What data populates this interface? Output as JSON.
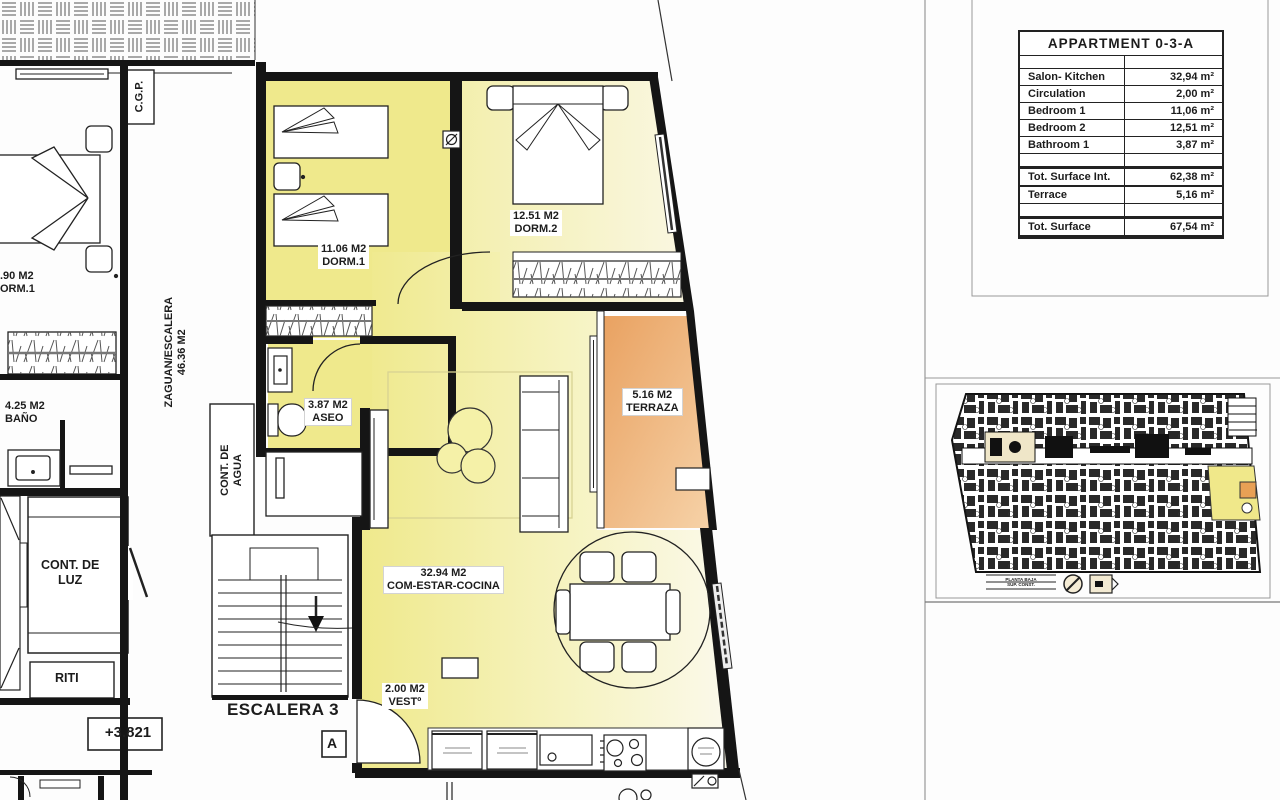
{
  "plan": {
    "rooms": {
      "dorm1": {
        "area": "11.06 M2",
        "name": "DORM.1"
      },
      "dorm2": {
        "area": "12.51 M2",
        "name": "DORM.2"
      },
      "aseo": {
        "area": "3.87 M2",
        "name": "ASEO"
      },
      "salon": {
        "area": "32.94 M2",
        "name": "COM-ESTAR-COCINA"
      },
      "vest": {
        "area": "2.00 M2",
        "name": "VESTº"
      },
      "terraza": {
        "area": "5.16 M2",
        "name": "TERRAZA"
      },
      "bano": {
        "area": "4.25 M2",
        "name": "BAÑO"
      },
      "neighbor_dorm": {
        "area": ".90 M2",
        "name": "ORM.1"
      },
      "zaguan": {
        "name": "ZAGUAN/ESCALERA",
        "area": "46.36 M2"
      },
      "cont_agua_line1": "CONT. DE",
      "cont_agua_line2": "AGUA",
      "cont_luz_line1": "CONT. DE",
      "cont_luz_line2": "LUZ",
      "riti": "RITI",
      "cgp": "C.G.P.",
      "escalera": "ESCALERA 3",
      "section_mark": "A",
      "level_mark": "+3.821"
    }
  },
  "table": {
    "title": "APPARTMENT 0-3-A",
    "rows": [
      {
        "label": "Salon- Kitchen",
        "value": "32,94 m²"
      },
      {
        "label": "Circulation",
        "value": "2,00 m²"
      },
      {
        "label": "Bedroom 1",
        "value": "11,06 m²"
      },
      {
        "label": "Bedroom 2",
        "value": "12,51 m²"
      },
      {
        "label": "Bathroom 1",
        "value": "3,87 m²"
      }
    ],
    "subtotal": {
      "label": "Tot. Surface Int.",
      "value": "62,38 m²"
    },
    "terrace_row": {
      "label": "Terrace",
      "value": "5,16 m²"
    },
    "total": {
      "label": "Tot. Surface",
      "value": "67,54 m²"
    }
  },
  "keyplan": {
    "caption_line1": "PLANTA BAJA",
    "caption_line2": "SUP. CONST."
  },
  "colors": {
    "room_yellow": "#efe98c",
    "room_pale": "#faf7e2",
    "terrace_orange": "#e9a160",
    "wall": "#151515",
    "highlight_yellow": "#f0e88a",
    "highlight_orange": "#e8a055"
  }
}
